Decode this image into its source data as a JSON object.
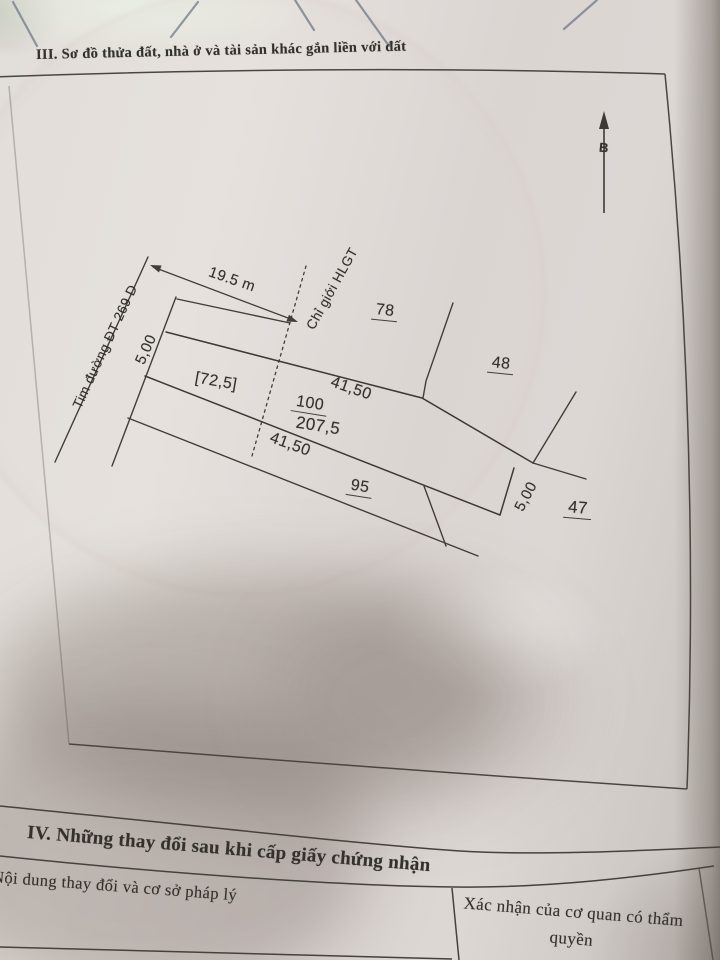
{
  "section3": {
    "title": "III. Sơ đồ thửa đất, nhà ở và tài sản khác gắn liền với đất"
  },
  "section4": {
    "title": "IV. Những thay đổi sau khi cấp giấy chứng nhận",
    "table": {
      "content_col_header": "Nội dung thay đổi và cơ sở pháp lý",
      "confirm_col_header": "Xác nhận của cơ quan có thẩm quyền"
    }
  },
  "diagram": {
    "north_label": "B",
    "road_centerline_label": "Tim đường ĐT 269 D",
    "road_width_dimension": "19.5 m",
    "corridor_boundary_label": "Chỉ giới HLGT",
    "parcel_number": "100",
    "parcel_area": "207,5",
    "corridor_area_bracket": "[72,5]",
    "top_edge_length": "41,50",
    "bottom_edge_length": "41,50",
    "left_width": "5,00",
    "right_width": "5,00",
    "adjacent_parcel_78": "78",
    "adjacent_parcel_48": "48",
    "adjacent_parcel_47": "47",
    "adjacent_parcel_95": "95"
  },
  "colors": {
    "paper": "#dcd6d3",
    "ink": "#34312c",
    "line": "#413e39",
    "hatch": "#76808c",
    "shadow": "#635750"
  }
}
